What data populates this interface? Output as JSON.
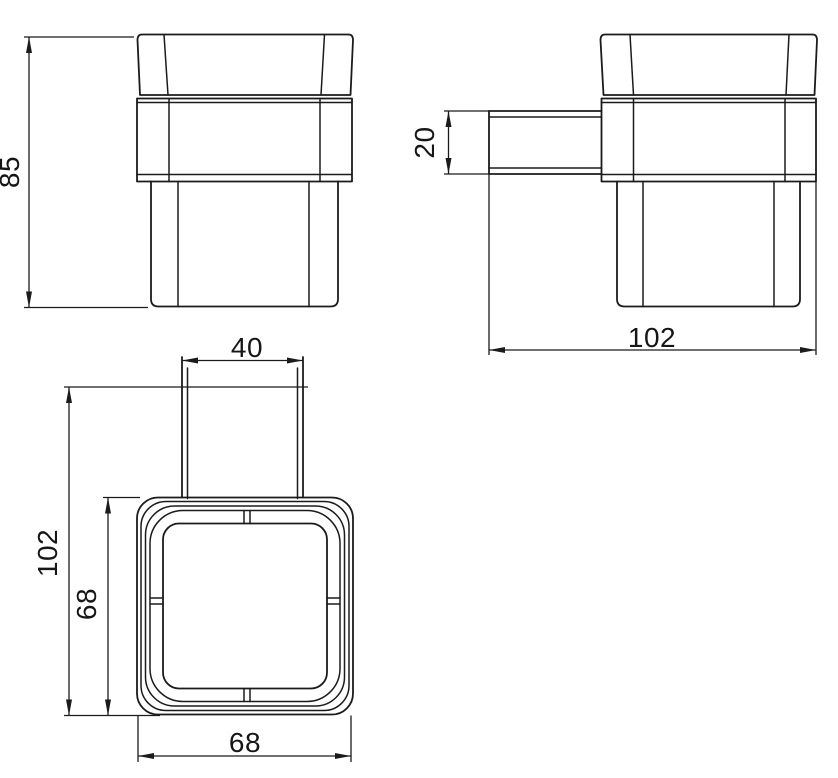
{
  "colors": {
    "line": "#1b1b1b",
    "background": "#ffffff"
  },
  "dimensions": {
    "front_height": {
      "value": "85",
      "view": "front",
      "orientation": "vertical"
    },
    "bracket_thickness": {
      "value": "20",
      "view": "side",
      "orientation": "vertical"
    },
    "side_depth": {
      "value": "102",
      "view": "side",
      "orientation": "horizontal"
    },
    "bracket_width": {
      "value": "40",
      "view": "top",
      "orientation": "horizontal"
    },
    "top_depth": {
      "value": "102",
      "view": "top",
      "orientation": "vertical"
    },
    "top_inner_depth": {
      "value": "68",
      "view": "top",
      "orientation": "vertical"
    },
    "top_width": {
      "value": "68",
      "view": "top",
      "orientation": "horizontal"
    }
  }
}
